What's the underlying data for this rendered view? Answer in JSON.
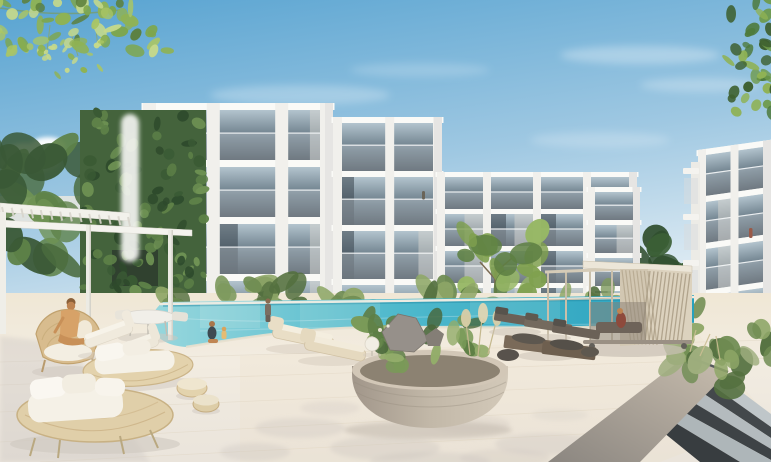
{
  "meta": {
    "title": "Residential complex exterior render",
    "type": "3d-architectural-render",
    "description": "3D architectural rendering of a modern white low-rise apartment complex with glass balconies, a long turquoise outdoor swimming pool, timber sun loungers, rattan daybeds with white cushions, a white pergola with a living green wall, a slatted wooden cabana, a round concrete planter with rocks and grasses, wide stone steps and a sunlit paved deck under a clear blue sky with overhanging leaves in the top corners.",
    "objects": [
      "apartment-building-left",
      "apartment-building-middle",
      "apartment-building-right",
      "swimming-pool",
      "pool-deck",
      "round-planter",
      "wooden-cabana",
      "white-pergola",
      "green-wall",
      "rattan-daybeds",
      "white-chaises",
      "timber-loungers",
      "concrete-steps",
      "angular-concrete-ramp",
      "hedges",
      "trees",
      "people-by-pool",
      "person-in-armchair",
      "balcony-figures",
      "overhanging-leaves"
    ],
    "building_count": 3,
    "floors_visible": 4,
    "people_visible": 7
  },
  "palette": {
    "sky_top": "#57A3D1",
    "sky_mid": "#9FC8E2",
    "sky_low": "#E2EDF4",
    "sky_horizon": "#EEF3F6",
    "cloud_white": "#FFFFFF",
    "glass_top": "#B3C4CE",
    "glass_mid": "#687A86",
    "glass_bot": "#414D57",
    "pool_left": "#98D7DD",
    "pool_mid": "#4FB9CC",
    "pool_right": "#28A1BE",
    "deck_top": "#F0E7D5",
    "deck_mid": "#F2ECE1",
    "deck_bottom": "#EAE4DB",
    "planter_dark": "#A1968A",
    "planter_mid": "#C2B8A8",
    "planter_light": "#D3C9B9",
    "ramp_light": "#C8BDAE",
    "ramp_dark": "#8B8680",
    "building_face": "#F1F0EC",
    "slab_white": "#FAFAF7",
    "accent_grey": "#8D9399",
    "foliage_light": "#C6D98A",
    "foliage_mid": "#8FB254",
    "foliage_dark": "#5C7F3C",
    "wood_cabana": "#DCD2BE",
    "wicker": "#DFCEA8",
    "cushion_white": "#F6F2E8",
    "concrete_step": "#B7BEC1",
    "concrete_dark": "#43484B"
  },
  "buildings": [
    {
      "id": "building-left-main",
      "x": 143,
      "y": 103,
      "w": 190,
      "floors": 4,
      "floorH": 57,
      "slabH": 7,
      "pierW": 13,
      "piers": [
        0,
        0.37,
        0.73,
        1
      ],
      "seed": 3
    },
    {
      "id": "building-left-wing",
      "x": 333,
      "y": 117,
      "w": 109,
      "floors": 4,
      "floorH": 54,
      "slabH": 6,
      "pierW": 9,
      "piers": [
        0,
        0.52,
        1
      ],
      "accents": [
        {
          "x": 2,
          "w": 26
        }
      ],
      "seed": 5
    },
    {
      "id": "building-mid-main",
      "x": 437,
      "y": 172,
      "w": 200,
      "floors": 4,
      "floorH": 37,
      "slabH": 5,
      "pierW": 8,
      "piers": [
        0,
        0.25,
        0.5,
        0.75,
        1
      ],
      "accents": [
        {
          "x": 118,
          "w": 27
        }
      ],
      "seed": 7
    },
    {
      "id": "building-mid-tower",
      "x": 588,
      "y": 187,
      "w": 52,
      "floors": 4,
      "floorH": 33,
      "slabH": 5,
      "pierW": 7,
      "piers": [
        0,
        1
      ],
      "seed": 9
    },
    {
      "id": "building-right",
      "x": 0,
      "y": 0,
      "w": 73,
      "floors": 4,
      "floorH": 47,
      "slabH": 6,
      "pierW": 8,
      "piers": [
        0,
        0.5,
        1
      ],
      "accents": [
        {
          "x": 38,
          "w": 30,
          "dy": 96
        }
      ],
      "transform": "translate(698,150) skewY(-8)",
      "seed": 11
    }
  ],
  "clusters": [
    {
      "id": "foliage-top-left",
      "x0": -15,
      "x1": 168,
      "y0": -15,
      "y1": 52,
      "n": 70,
      "rx": [
        4,
        10
      ],
      "ry": [
        2.5,
        6
      ],
      "colors": [
        "#A9C565",
        "#7FA648",
        "#C6D98A",
        "#5C7F3C",
        "#8FB254"
      ],
      "seed": 21
    },
    {
      "id": "foliage-top-left-sprigs",
      "x0": 30,
      "x1": 110,
      "y0": 38,
      "y1": 80,
      "n": 20,
      "rx": [
        2.5,
        5
      ],
      "ry": [
        1.5,
        3.5
      ],
      "colors": [
        "#A9C565",
        "#C6D98A",
        "#8FB254"
      ],
      "seed": 27
    },
    {
      "id": "foliage-top-right",
      "x0": 726,
      "x1": 788,
      "y0": -12,
      "y1": 118,
      "n": 42,
      "rx": [
        4,
        9
      ],
      "ry": [
        2.5,
        6
      ],
      "colors": [
        "#6E9A4A",
        "#4E7A3C",
        "#8FB254",
        "#3E6030"
      ],
      "seed": 33
    },
    {
      "id": "trees-left",
      "x0": -12,
      "x1": 128,
      "y0": 140,
      "y1": 262,
      "n": 26,
      "rx": [
        10,
        26
      ],
      "ry": [
        8,
        20
      ],
      "colors": [
        "#4A6B3E",
        "#5E8248",
        "#3A5836",
        "#6F9254"
      ],
      "seed": 55
    },
    {
      "id": "green-wall-texture",
      "x0": 82,
      "x1": 204,
      "y0": 112,
      "y1": 330,
      "n": 120,
      "rx": [
        3.5,
        8
      ],
      "ry": [
        2.5,
        6
      ],
      "colors": [
        "#5E8148",
        "#3A5A34",
        "#6F9254",
        "#2E4A2C"
      ],
      "seed": 41
    },
    {
      "id": "conifer-gap",
      "x0": 636,
      "x1": 720,
      "y0": 232,
      "y1": 322,
      "n": 16,
      "rx": [
        7,
        14
      ],
      "ry": [
        12,
        26
      ],
      "colors": [
        "#3C5F36",
        "#2F4D2C",
        "#4E7342"
      ],
      "seed": 61
    },
    {
      "id": "front-tree-canopy",
      "x0": 460,
      "x1": 538,
      "y0": 228,
      "y1": 298,
      "n": 18,
      "rx": [
        8,
        17
      ],
      "ry": [
        6,
        12
      ],
      "colors": [
        "#7FA04F",
        "#97B765",
        "#5D7F42"
      ],
      "seed": 71
    },
    {
      "id": "hedge-row-a",
      "x0": 158,
      "x1": 452,
      "y0": 282,
      "y1": 310,
      "n": 26,
      "rx": [
        9,
        18
      ],
      "ry": [
        6,
        11
      ],
      "colors": [
        "#6F8C52",
        "#8FA768",
        "#54703F",
        "#7E9A5E"
      ],
      "seed": 81
    },
    {
      "id": "hedge-row-b",
      "x0": 450,
      "x1": 702,
      "y0": 288,
      "y1": 316,
      "n": 24,
      "rx": [
        8,
        15
      ],
      "ry": [
        5,
        9
      ],
      "colors": [
        "#6F8C52",
        "#8FA768",
        "#54703F",
        "#7E9A5E"
      ],
      "seed": 91
    },
    {
      "id": "bushes-right",
      "x0": 666,
      "x1": 778,
      "y0": 328,
      "y1": 396,
      "n": 22,
      "rx": [
        9,
        17
      ],
      "ry": [
        6,
        12
      ],
      "colors": [
        "#6F8C52",
        "#54703F",
        "#8FA768",
        "#9FAE7E"
      ],
      "seed": 101
    },
    {
      "id": "grass-mid-right",
      "x0": 598,
      "x1": 668,
      "y0": 298,
      "y1": 330,
      "n": 10,
      "rx": [
        6,
        11
      ],
      "ry": [
        4,
        8
      ],
      "colors": [
        "#8FA768",
        "#9FAE7E",
        "#6F8C52"
      ],
      "seed": 111
    },
    {
      "id": "planter-plants",
      "x0": 362,
      "x1": 502,
      "y0": 318,
      "y1": 366,
      "n": 28,
      "rx": [
        6,
        14
      ],
      "ry": [
        4,
        9
      ],
      "colors": [
        "#5E7F46",
        "#7A9A58",
        "#93AC6A",
        "#48663A"
      ],
      "seed": 121
    }
  ],
  "combs": [
    {
      "id": "pergola-roof-slats",
      "x1": 2,
      "y1": 207,
      "x2": 128,
      "y2": 217,
      "vx": 2,
      "vy": 9,
      "n": 14,
      "stroke": "#D8D5CC",
      "w": 2,
      "op": 0.9
    },
    {
      "id": "cabana-slats-right",
      "x1": 650,
      "y1": 271,
      "x2": 690,
      "y2": 274,
      "vx": -9,
      "vy": 70,
      "n": 11,
      "stroke": "#AA9D85",
      "w": 1.3,
      "op": 0.85
    },
    {
      "id": "cabana-slats-left",
      "x1": 622,
      "y1": 270,
      "x2": 648,
      "y2": 271,
      "vx": 9,
      "vy": 74,
      "n": 8,
      "stroke": "#B3A68D",
      "w": 1.2,
      "op": 0.8
    }
  ]
}
